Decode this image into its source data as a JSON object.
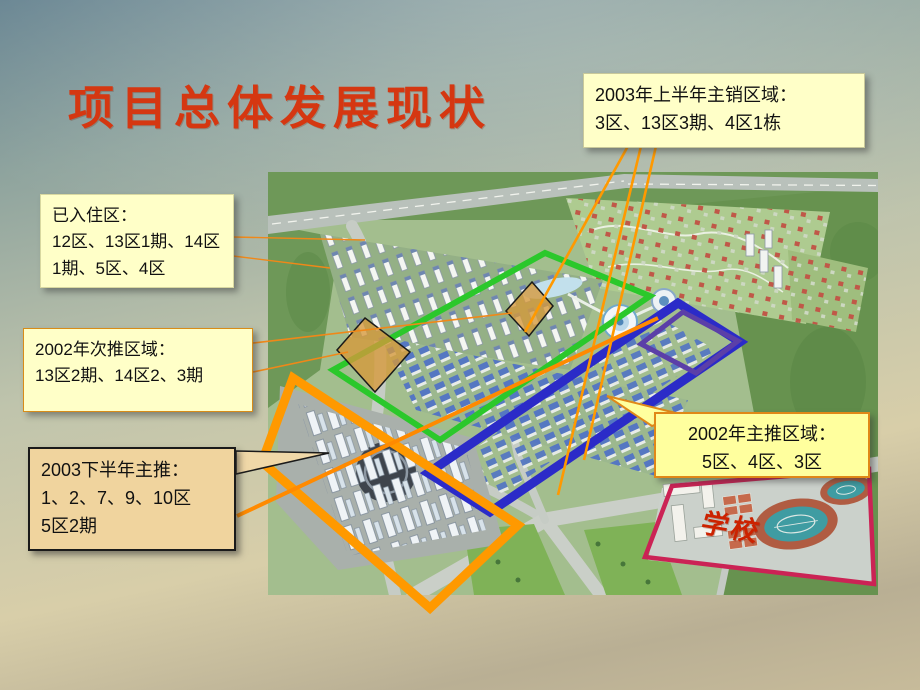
{
  "slide": {
    "title": "项目总体发展现状"
  },
  "callouts": {
    "occupied": {
      "title": "已入住区：",
      "body": "12区、13区1期、14区1期、5区、4区"
    },
    "secondary_2002": {
      "title": "2002年次推区域：",
      "body": "13区2期、14区2、3期"
    },
    "sales_2003_h1": {
      "title": "2003年上半年主销区域：",
      "body": "3区、13区3期、4区1栋"
    },
    "push_2003_h2": {
      "title": "2003下半年主推：",
      "line1": "1、2、7、9、10区",
      "line2": "5区2期"
    },
    "push_2002": {
      "title": "2002年主推区域：",
      "body": "5区、4区、3区"
    }
  },
  "map": {
    "school_label": "学校"
  },
  "colors": {
    "title_text": "#D53711",
    "callout_yellow": "#FFFFC8",
    "callout_bright_yellow": "#FFFF9E",
    "callout_tan": "#F0D49E",
    "outline_green": "#2BC82B",
    "outline_blue": "#2B2BC8",
    "outline_inner_purple": "#5B3FA8",
    "outline_orange": "#FF9900",
    "outline_pink": "#CB2355",
    "connector_orange": "#F08818",
    "school_text": "#CC2200"
  }
}
